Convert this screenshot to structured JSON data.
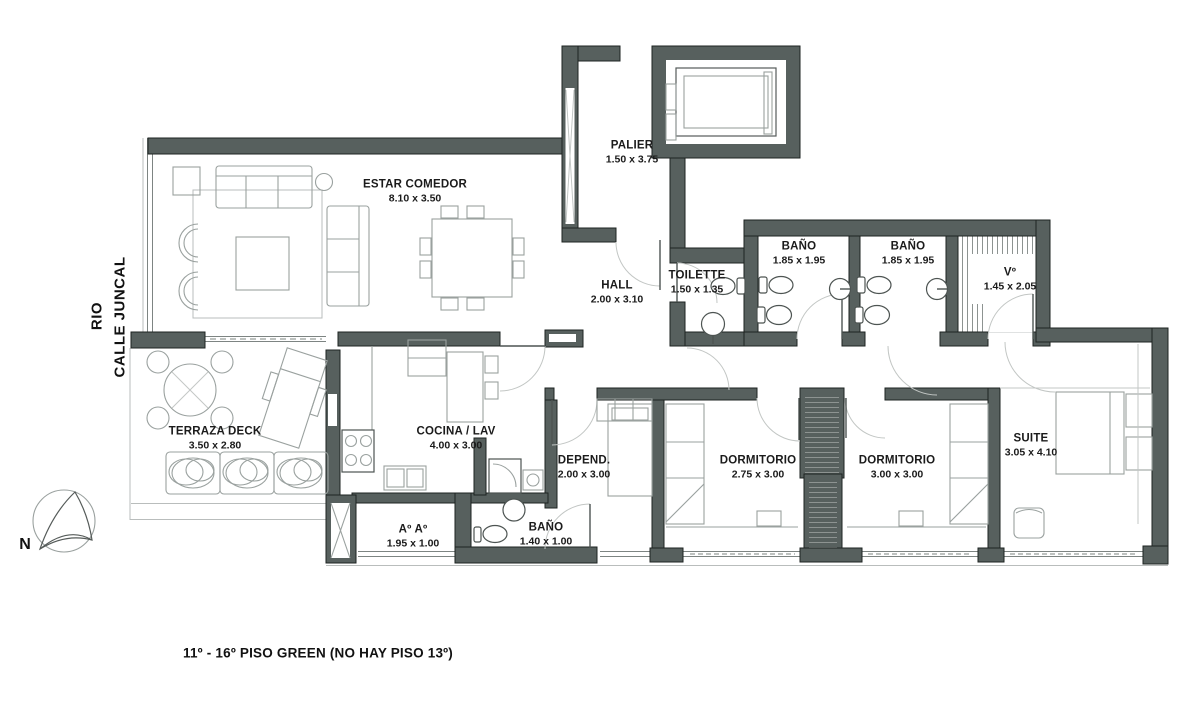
{
  "meta": {
    "caption": "11º - 16º PISO GREEN (NO HAY PISO 13º)"
  },
  "streets": {
    "rio": "RIO",
    "calle_juncal": "CALLE JUNCAL"
  },
  "compass": {
    "north_label": "N"
  },
  "colors": {
    "wall": "#57605e",
    "wall_outline": "#1d2321",
    "furniture_line": "#9aa19f",
    "fixture_line": "#4d5452",
    "door_arc": "#c2c6c4",
    "text": "#1b1b1b",
    "background": "#ffffff"
  },
  "rooms": [
    {
      "id": "estar-comedor",
      "name": "ESTAR COMEDOR",
      "dims": "8.10 x 3.50",
      "x": 415,
      "y": 192
    },
    {
      "id": "palier",
      "name": "PALIER",
      "dims": "1.50 x 3.75",
      "x": 632,
      "y": 153
    },
    {
      "id": "hall",
      "name": "HALL",
      "dims": "2.00 x 3.10",
      "x": 617,
      "y": 293
    },
    {
      "id": "toilette",
      "name": "TOILETTE",
      "dims": "1.50 x 1.35",
      "x": 697,
      "y": 283
    },
    {
      "id": "bano-1",
      "name": "BAÑO",
      "dims": "1.85 x 1.95",
      "x": 799,
      "y": 254
    },
    {
      "id": "bano-2",
      "name": "BAÑO",
      "dims": "1.85 x 1.95",
      "x": 908,
      "y": 254
    },
    {
      "id": "vestidor",
      "name": "Vº",
      "dims": "1.45 x 2.05",
      "x": 1010,
      "y": 280
    },
    {
      "id": "terraza-deck",
      "name": "TERRAZA DECK",
      "dims": "3.50 x 2.80",
      "x": 215,
      "y": 439
    },
    {
      "id": "cocina-lav",
      "name": "COCINA / LAV",
      "dims": "4.00 x 3.00",
      "x": 456,
      "y": 439
    },
    {
      "id": "aire-acond",
      "name": "Aº Aº",
      "dims": "1.95 x 1.00",
      "x": 413,
      "y": 537
    },
    {
      "id": "bano-3",
      "name": "BAÑO",
      "dims": "1.40 x 1.00",
      "x": 546,
      "y": 535
    },
    {
      "id": "dependencia",
      "name": "DEPEND.",
      "dims": "2.00 x 3.00",
      "x": 584,
      "y": 468
    },
    {
      "id": "dormitorio-1",
      "name": "DORMITORIO",
      "dims": "2.75 x 3.00",
      "x": 758,
      "y": 468
    },
    {
      "id": "dormitorio-2",
      "name": "DORMITORIO",
      "dims": "3.00 x 3.00",
      "x": 897,
      "y": 468
    },
    {
      "id": "suite",
      "name": "SUITE",
      "dims": "3.05 x 4.10",
      "x": 1031,
      "y": 446
    }
  ]
}
